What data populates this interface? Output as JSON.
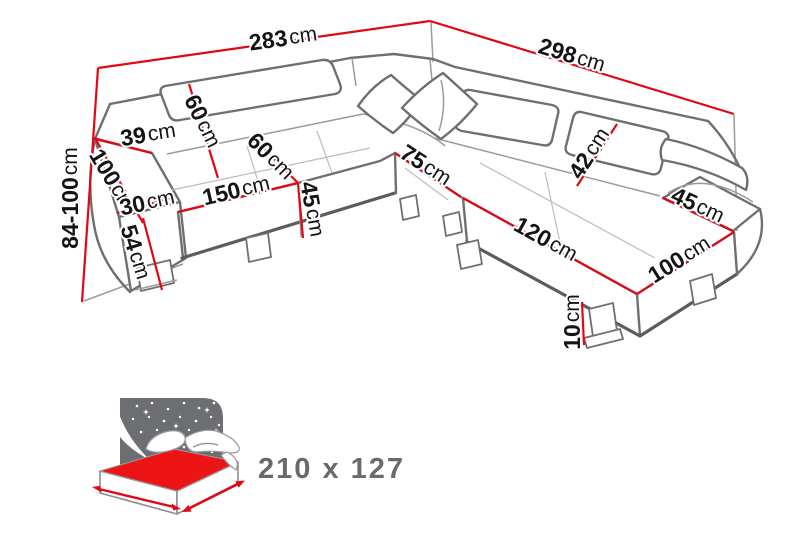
{
  "diagram": {
    "type": "corner-sofa-dimension-drawing",
    "unit": "cm",
    "dimensions": [
      {
        "id": "total-width-left",
        "value": "283",
        "unit": "cm"
      },
      {
        "id": "total-width-right",
        "value": "298",
        "unit": "cm"
      },
      {
        "id": "total-height-range",
        "value": "84-100",
        "unit": "cm"
      },
      {
        "id": "armrest-top-width",
        "value": "39",
        "unit": "cm"
      },
      {
        "id": "backrest-height",
        "value": "60",
        "unit": "cm"
      },
      {
        "id": "armrest-length",
        "value": "100",
        "unit": "cm"
      },
      {
        "id": "armrest-width",
        "value": "30",
        "unit": "cm"
      },
      {
        "id": "armrest-front-height",
        "value": "54",
        "unit": "cm"
      },
      {
        "id": "seat-width",
        "value": "150",
        "unit": "cm"
      },
      {
        "id": "seat-depth",
        "value": "60",
        "unit": "cm"
      },
      {
        "id": "seat-height",
        "value": "45",
        "unit": "cm"
      },
      {
        "id": "corner-seat-width",
        "value": "75",
        "unit": "cm"
      },
      {
        "id": "headrest-height",
        "value": "42",
        "unit": "cm"
      },
      {
        "id": "chaise-length",
        "value": "120",
        "unit": "cm"
      },
      {
        "id": "chaise-width",
        "value": "100",
        "unit": "cm"
      },
      {
        "id": "right-armrest-depth",
        "value": "45",
        "unit": "cm"
      },
      {
        "id": "leg-height",
        "value": "10",
        "unit": "cm"
      }
    ],
    "sleeping_function": {
      "size_label": "210 x 127"
    }
  },
  "colors": {
    "dimension_red": "#e30613",
    "label_black": "#141414",
    "icon_panel_gray": "#6d6e71",
    "icon_text_gray": "#6a6a6d",
    "mattress_red": "#ec1414"
  }
}
